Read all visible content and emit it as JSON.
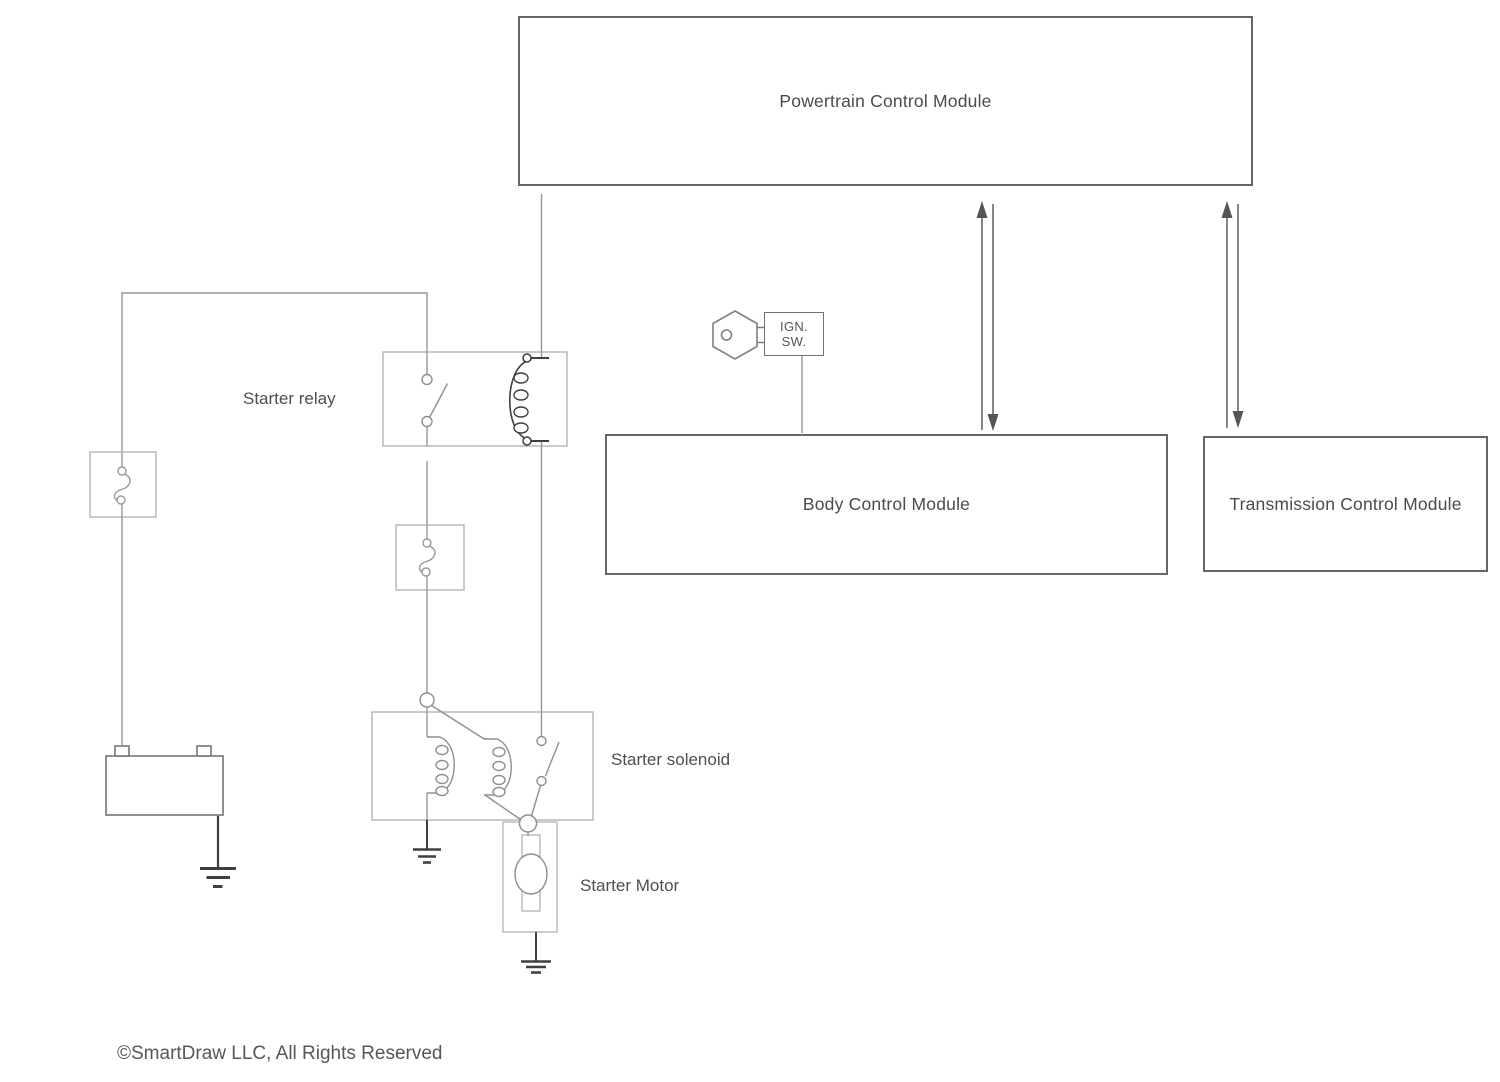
{
  "diagram": {
    "modules": {
      "pcm": {
        "label": "Powertrain Control Module"
      },
      "bcm": {
        "label": "Body Control Module"
      },
      "tcm": {
        "label": "Transmission Control Module"
      }
    },
    "ignition_switch": {
      "line1": "IGN.",
      "line2": "SW."
    },
    "labels": {
      "starter_relay": "Starter relay",
      "starter_solenoid": "Starter solenoid",
      "starter_motor": "Starter Motor"
    },
    "battery": {
      "positive_terminal": "+",
      "negative_terminal": "−"
    },
    "starter_motor_symbol": "M",
    "footer": {
      "copyright": "©SmartDraw LLC, All Rights Reserved"
    },
    "colors": {
      "wire": "#979797",
      "module_border": "#666666",
      "component_border": "#b4b4b4",
      "dark_symbol": "#3f3f3f",
      "arrow": "#5f5f5f",
      "text": "#4b4b4b"
    }
  }
}
